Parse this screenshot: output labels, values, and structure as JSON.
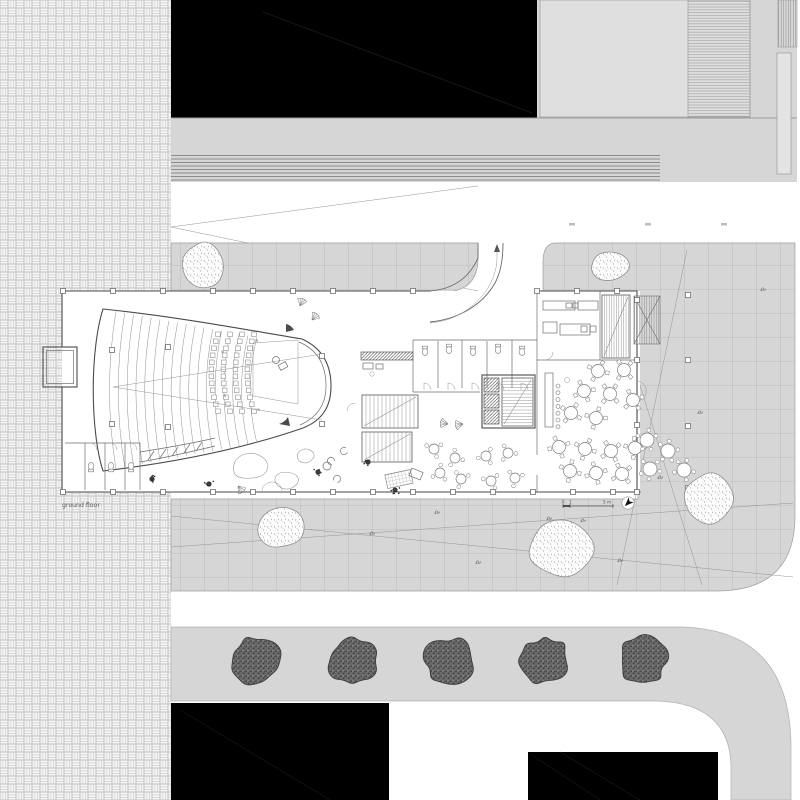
{
  "labels": {
    "floor_label": "ground floor",
    "scale": {
      "zero": "0",
      "one": "1",
      "five": "5 m"
    }
  },
  "palette": {
    "paving_gray": "#d6d6d6",
    "grid_line": "#a6a6a6",
    "massing_black": "#000000",
    "wall": "#4a4a4a",
    "tree_fill": "#6a6a6a",
    "weave_line": "#c8c8c8",
    "label_text": "#5a5a5a"
  },
  "site": {
    "grid_size": 24,
    "trees": {
      "cy": 661,
      "r": 24,
      "cx": [
        256,
        352,
        449,
        545,
        642
      ]
    },
    "boulders": [
      [
        203,
        267,
        20,
        25,
        11
      ],
      [
        609,
        267,
        21,
        15,
        22
      ],
      [
        282,
        527,
        24,
        22,
        33
      ],
      [
        562,
        548,
        33,
        29,
        44
      ],
      [
        708,
        500,
        25,
        28,
        55
      ]
    ],
    "road_stripes": {
      "x1": 171,
      "x2": 660,
      "y0": 155.5,
      "n": 8,
      "dy": 3.5
    },
    "road_dashes": [
      [
        569,
        223
      ],
      [
        645,
        223
      ],
      [
        721,
        223
      ]
    ],
    "plaza_posts": {
      "x": 688,
      "ys": [
        295,
        360,
        426,
        488
      ]
    },
    "glyphs": [
      [
        372,
        533
      ],
      [
        437,
        512
      ],
      [
        478,
        562
      ],
      [
        549,
        518
      ],
      [
        583,
        520
      ],
      [
        700,
        412
      ],
      [
        763,
        289
      ],
      [
        660,
        477
      ],
      [
        620,
        560
      ],
      [
        425,
        297
      ]
    ]
  },
  "building": {
    "wall_posts": {
      "top": {
        "y": 291,
        "xs": [
          63,
          113,
          163,
          213,
          253,
          293,
          333,
          373,
          413
        ]
      },
      "bottom": {
        "y": 492,
        "xs": [
          63,
          113,
          163,
          213,
          253,
          293,
          333,
          373,
          413,
          453,
          493,
          533,
          573,
          613,
          637
        ]
      },
      "right": {
        "x": 637,
        "ys": [
          300,
          360,
          425
        ]
      },
      "kitchen_top": {
        "y": 291,
        "xs": [
          537,
          577,
          617
        ]
      },
      "inner": [
        [
          112,
          350
        ],
        [
          112,
          424
        ],
        [
          168,
          347
        ],
        [
          168,
          427
        ],
        [
          322,
          356
        ],
        [
          322,
          424
        ]
      ]
    },
    "auditorium": {
      "rows": {
        "n": 17,
        "x0": 112,
        "dx": 8.8
      },
      "seats": {
        "cols": [
          214,
          226,
          238,
          250
        ],
        "y0": 332,
        "dy": 7,
        "n": 12,
        "size": 4.6
      },
      "w_marks": [
        [
          221,
          353
        ],
        [
          223,
          397
        ],
        [
          255,
          342
        ],
        [
          257,
          411
        ]
      ]
    },
    "stairs": [
      [
        362,
        395,
        56,
        33,
        4,
        "v"
      ],
      [
        362,
        432,
        50,
        30,
        4,
        "v"
      ],
      [
        502,
        378,
        31,
        48,
        3.2,
        "h"
      ],
      [
        602,
        295,
        28,
        63,
        2.4,
        "v"
      ]
    ],
    "elevators": [
      [
        484,
        378,
        15,
        14
      ],
      [
        484,
        394,
        15,
        14
      ],
      [
        484,
        410,
        15,
        14
      ]
    ],
    "bar": {
      "x": 545,
      "y": 373,
      "w": 8,
      "h": 54,
      "stools": {
        "x": 558,
        "y0": 386,
        "dy": 6.8,
        "n": 7,
        "r": 2
      }
    },
    "tables_dining": {
      "r": 6.5,
      "pts": [
        [
          598,
          371
        ],
        [
          624,
          370
        ],
        [
          584,
          391
        ],
        [
          610,
          394
        ],
        [
          633,
          400
        ],
        [
          571,
          413
        ],
        [
          596,
          418
        ],
        [
          559,
          447
        ],
        [
          585,
          449
        ],
        [
          611,
          451
        ],
        [
          635,
          448
        ],
        [
          570,
          471
        ],
        [
          596,
          473
        ],
        [
          622,
          474
        ]
      ]
    },
    "tables_lobby": {
      "r": 5,
      "pts": [
        [
          434,
          449
        ],
        [
          455,
          458
        ],
        [
          440,
          473
        ],
        [
          461,
          479
        ],
        [
          486,
          456
        ],
        [
          508,
          453
        ],
        [
          491,
          481
        ],
        [
          515,
          478
        ]
      ]
    },
    "tables_outdoor": {
      "r": 7,
      "pts": [
        [
          647,
          440
        ],
        [
          668,
          451
        ],
        [
          650,
          469
        ],
        [
          684,
          470
        ]
      ]
    },
    "toilets": [
      [
        425,
        352,
        0
      ],
      [
        449,
        350,
        0
      ],
      [
        473,
        352,
        0
      ],
      [
        498,
        350,
        0
      ],
      [
        522,
        352,
        0
      ],
      [
        91,
        466,
        180
      ],
      [
        111,
        466,
        180
      ],
      [
        131,
        466,
        180
      ]
    ],
    "planters": [
      [
        250,
        466,
        19,
        14,
        66
      ],
      [
        287,
        480,
        12,
        9,
        77
      ],
      [
        306,
        456,
        9,
        7,
        88
      ]
    ],
    "dark_plants": [
      [
        152,
        479
      ],
      [
        209,
        484
      ],
      [
        318,
        472
      ],
      [
        368,
        462
      ],
      [
        395,
        490
      ]
    ],
    "leaf_fans": [
      [
        300,
        306,
        20
      ],
      [
        312,
        320,
        40
      ],
      [
        448,
        424,
        -80
      ],
      [
        463,
        424,
        -100
      ],
      [
        238,
        486,
        140
      ]
    ],
    "armchairs": [
      [
        331,
        461,
        40
      ],
      [
        344,
        451,
        -20
      ],
      [
        337,
        479,
        120
      ]
    ]
  }
}
